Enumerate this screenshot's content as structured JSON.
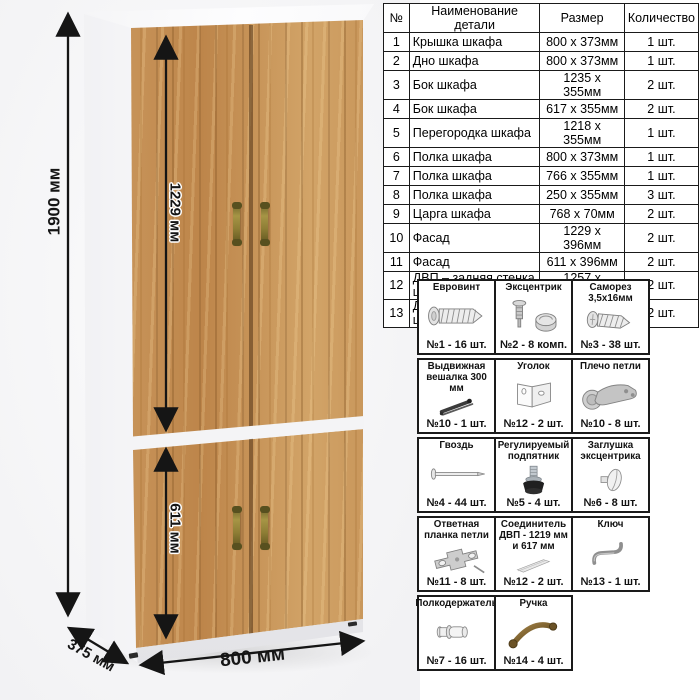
{
  "parts_table": {
    "headers": {
      "num": "№",
      "name": "Наименование детали",
      "size": "Размер",
      "qty": "Количество"
    },
    "rows": [
      {
        "num": "1",
        "name": "Крышка шкафа",
        "size": "800 х 373мм",
        "qty": "1 шт."
      },
      {
        "num": "2",
        "name": "Дно шкафа",
        "size": "800 х 373мм",
        "qty": "1 шт."
      },
      {
        "num": "3",
        "name": "Бок шкафа",
        "size": "1235 х 355мм",
        "qty": "2 шт."
      },
      {
        "num": "4",
        "name": "Бок шкафа",
        "size": "617 х 355мм",
        "qty": "2 шт."
      },
      {
        "num": "5",
        "name": "Перегородка шкафа",
        "size": "1218 х 355мм",
        "qty": "1 шт."
      },
      {
        "num": "6",
        "name": "Полка шкафа",
        "size": "800 х 373мм",
        "qty": "1 шт."
      },
      {
        "num": "7",
        "name": "Полка шкафа",
        "size": "766 х 355мм",
        "qty": "1 шт."
      },
      {
        "num": "8",
        "name": "Полка шкафа",
        "size": "250 х 355мм",
        "qty": "3 шт."
      },
      {
        "num": "9",
        "name": "Царга шкафа",
        "size": "768 х 70мм",
        "qty": "2 шт."
      },
      {
        "num": "10",
        "name": "Фасад",
        "size": "1229 х 396мм",
        "qty": "2 шт."
      },
      {
        "num": "11",
        "name": "Фасад",
        "size": "611 х 396мм",
        "qty": "2 шт."
      },
      {
        "num": "12",
        "name": "ДВП – задняя стенка шкафа",
        "size": "1257 х 396мм",
        "qty": "2 шт."
      },
      {
        "num": "13",
        "name": "ДВП – задняя стенка шкафа",
        "size": "639 х 396мм",
        "qty": "2 шт."
      }
    ]
  },
  "hardware": {
    "rows": [
      [
        {
          "title": "Евровинт",
          "count": "№1 - 16 шт.",
          "icon": "euroscrew-icon"
        },
        {
          "title": "Эксцентрик",
          "count": "№2 - 8 комп.",
          "icon": "cam-lock-icon"
        },
        {
          "title": "Саморез 3,5х16мм",
          "count": "№3 - 38 шт.",
          "icon": "screw-icon"
        }
      ],
      [
        {
          "title": "Выдвижная вешалка 300 мм",
          "count": "№10 - 1 шт.",
          "icon": "pullout-hanger-icon"
        },
        {
          "title": "Уголок",
          "count": "№12 - 2 шт.",
          "icon": "corner-bracket-icon"
        },
        {
          "title": "Плечо петли",
          "count": "№10 - 8 шт.",
          "icon": "hinge-arm-icon"
        }
      ],
      [
        {
          "title": "Гвоздь",
          "count": "№4 - 44 шт.",
          "icon": "nail-icon"
        },
        {
          "title": "Регулируемый подпятник",
          "count": "№5 - 4 шт.",
          "icon": "adjustable-foot-icon"
        },
        {
          "title": "Заглушка эксцентрика",
          "count": "№6 - 8 шт.",
          "icon": "cam-cap-icon"
        }
      ],
      [
        {
          "title": "Ответная планка петли",
          "count": "№11 - 8 шт.",
          "icon": "hinge-plate-icon"
        },
        {
          "title": "Соединитель ДВП - 1219 мм и 617 мм",
          "count": "№12 - 2 шт.",
          "icon": "hdf-connector-icon"
        },
        {
          "title": "Ключ",
          "count": "№13 - 1 шт.",
          "icon": "hex-key-icon"
        }
      ],
      [
        {
          "title": "Полкодержатель",
          "count": "№7 - 16 шт.",
          "icon": "shelf-pin-icon"
        },
        {
          "title": "Ручка",
          "count": "№14 - 4 шт.",
          "icon": "handle-icon"
        }
      ]
    ]
  },
  "dimensions": {
    "height": "1900 мм",
    "upper_door_height": "1229 мм",
    "lower_door_height": "611 мм",
    "width": "800 мм",
    "depth": "375 мм"
  },
  "colors": {
    "wood_base": "#c69a62",
    "wood_dark": "#a07440",
    "wood_light": "#dcb680",
    "handle_bronze": "#8f7d36",
    "carcass_white": "#fcfcfd",
    "dimension_black": "#151515"
  }
}
